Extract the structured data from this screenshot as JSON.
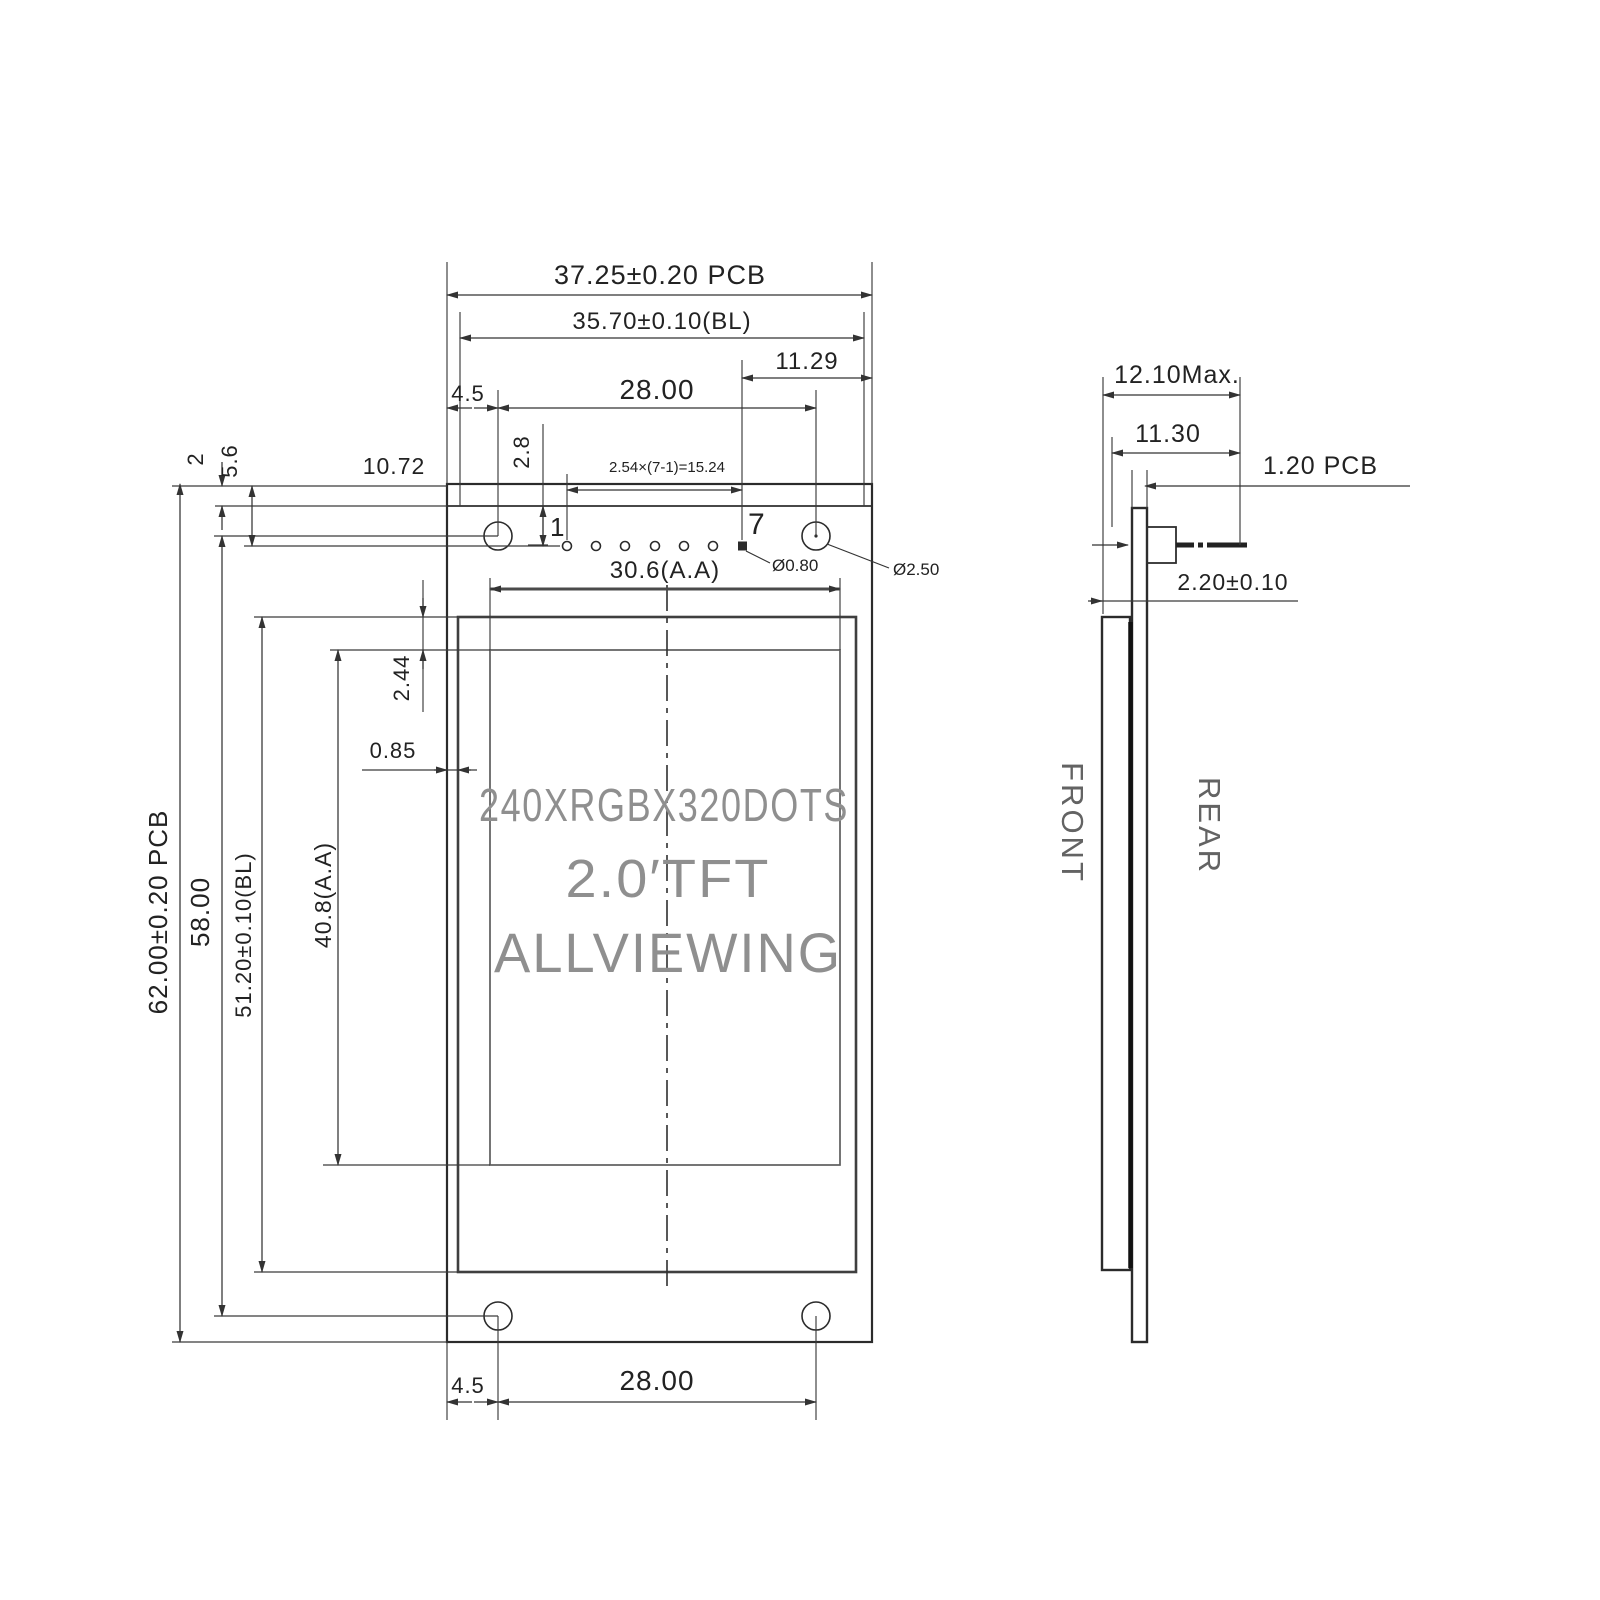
{
  "front_view": {
    "top_dims": {
      "pcb_width": "37.25±0.20 PCB",
      "bl_width": "35.70±0.10(BL)",
      "hole_spacing": "28.00",
      "right_offset": "11.29",
      "left_offset": "4.5",
      "pin_col_offset": "2.8",
      "edge_to_pin1": "10.72",
      "pin_pitch": "2.54×(7-1)=15.24"
    },
    "left_dims": {
      "pcb_height": "62.00±0.20 PCB",
      "hole_spacing": "58.00",
      "bl_height": "51.20±0.10(BL)",
      "aa_height": "40.8(A.A)",
      "top_margin": "2",
      "pin_row_offset": "5.6",
      "bezel_offset": "2.44",
      "edge_gap": "0.85"
    },
    "bottom_dims": {
      "left_offset": "4.5",
      "hole_spacing": "28.00"
    },
    "aa_width": "30.6(A.A)",
    "pins": {
      "first": "1",
      "last": "7"
    },
    "holes": {
      "pin_hole": "Ø0.80",
      "mount_hole": "Ø2.50"
    },
    "display": {
      "line1": "240XRGBX320DOTS",
      "line2": "2.0′TFT",
      "line3": "ALLVIEWING"
    }
  },
  "side_view": {
    "total_depth": "12.10Max.",
    "module_depth": "11.30",
    "pcb_thickness": "1.20 PCB",
    "panel_thickness": "2.20±0.10",
    "front_label": "FRONT",
    "rear_label": "REAR"
  },
  "colors": {
    "line": "#2b2b2b",
    "ghost_text": "#8f8f8f",
    "background": "#ffffff"
  }
}
